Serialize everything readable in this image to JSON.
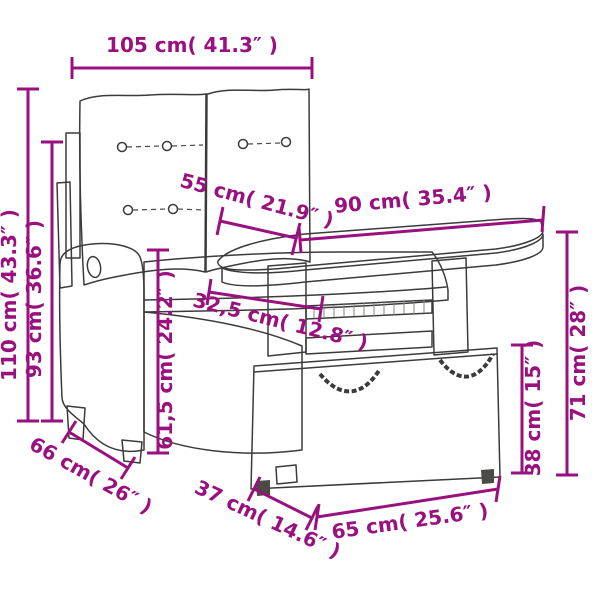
{
  "diagram": {
    "kind": "furniture-dimension-diagram",
    "items": "garden bench with cushions, garden table, storage stool"
  },
  "colors": {
    "accent": "#99107E",
    "sketch": "#3b3b3b"
  },
  "dims": [
    {
      "id": "overall-width",
      "label": "105 cm( 41.3″ )"
    },
    {
      "id": "overall-height",
      "label": "110 cm( 43.3″ )"
    },
    {
      "id": "backrest-height",
      "label": "93 cm( 36.6″ )"
    },
    {
      "id": "seat-back-height",
      "label": "61,5 cm( 24.2″ )"
    },
    {
      "id": "tabletop-depth",
      "label": "55 cm( 21.9″ )"
    },
    {
      "id": "tabletop-width",
      "label": "90 cm( 35.4″ )"
    },
    {
      "id": "clearance",
      "label": "32,5 cm( 12.8″ )"
    },
    {
      "id": "table-height",
      "label": "71 cm( 28″ )"
    },
    {
      "id": "stool-height",
      "label": "38 cm( 15″ )"
    },
    {
      "id": "bench-depth",
      "label": "66 cm( 26″ )"
    },
    {
      "id": "stool-depth",
      "label": "37 cm( 14.6″ )"
    },
    {
      "id": "stool-width",
      "label": "65 cm( 25.6″ )"
    }
  ]
}
